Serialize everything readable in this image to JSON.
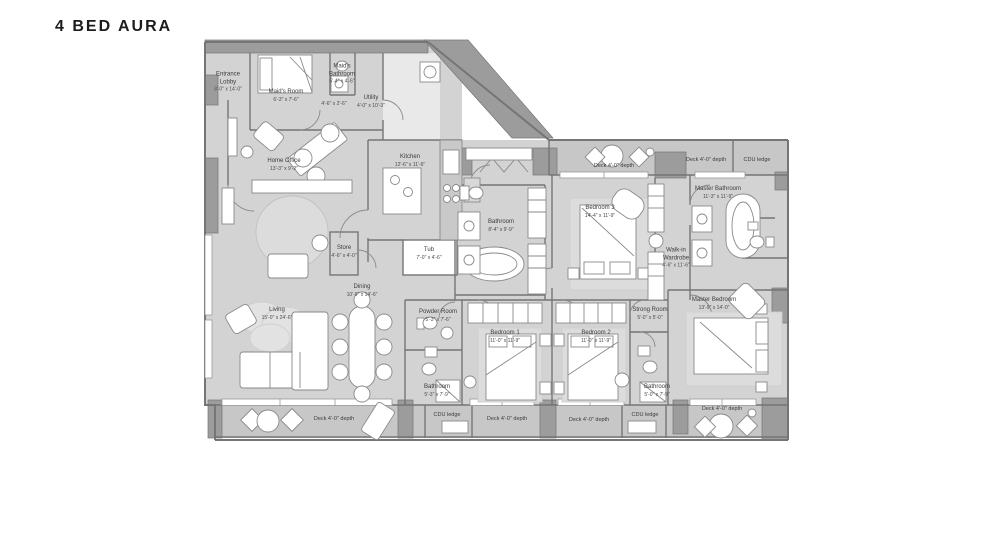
{
  "title": "4 BED AURA",
  "rooms": [
    {
      "name": "Entrance Lobby",
      "dims": "3'-0\" x 14'-0\""
    },
    {
      "name": "Maid's Room",
      "dims": "6'-3\" x 7'-6\""
    },
    {
      "name": "Maid's Bathroom",
      "dims": "5'-4\" x 4'-6\""
    },
    {
      "name": "Utility",
      "dims": "4'-0\" x 10'-3\""
    },
    {
      "name": "Home Office",
      "dims": "13'-3\" x 9'-2\""
    },
    {
      "name": "Kitchen",
      "dims": "12'-6\" x 11'-6\""
    },
    {
      "name": "Store",
      "dims": "4'-6\" x 4'-0\""
    },
    {
      "name": "Tub",
      "dims": "7'-0\" x 4'-6\""
    },
    {
      "name": "Bathroom",
      "dims": "8'-4\" x 9'-9\""
    },
    {
      "name": "Dining",
      "dims": "10'-9\" x 14'-6\""
    },
    {
      "name": "Living",
      "dims": "15'-0\" x 24'-6\""
    },
    {
      "name": "Bedroom 3",
      "dims": "14'-4\" x 11'-9\""
    },
    {
      "name": "Walk-in Wardrobe",
      "dims": "4'-6\" x 11'-6\""
    },
    {
      "name": "Master Bathroom",
      "dims": "11'-3\" x 11'-9\""
    },
    {
      "name": "Master Bedroom",
      "dims": "13'-9\" x 14'-0\""
    },
    {
      "name": "Strong Room",
      "dims": "5'-0\" x 5'-0\""
    },
    {
      "name": "Bedroom 1",
      "dims": "11'-0\" x 11'-9\""
    },
    {
      "name": "Bedroom 2",
      "dims": "11'-0\" x 11'-9\""
    },
    {
      "name": "Powder Room",
      "dims": "5'-3\" x 7'-6\""
    },
    {
      "name": "Bathroom",
      "dims": "5'-3\" x 7'-9\""
    },
    {
      "name": "Bathroom",
      "dims": "5'-0\" x 7'-9\""
    },
    {
      "name": "",
      "dims": "4'-6\" x 2'-6\""
    }
  ],
  "decks": [
    {
      "label": "Deck 4'-0\" depth"
    },
    {
      "label": "Deck 4'-0\" depth"
    },
    {
      "label": "CDU ledge"
    },
    {
      "label": "Deck 4'-0\" depth"
    },
    {
      "label": "CDU ledge"
    },
    {
      "label": "Deck 4'-0\" depth"
    },
    {
      "label": "Deck 4'-0\" depth"
    },
    {
      "label": "CDU ledge"
    },
    {
      "label": "Deck 4'-0\" depth"
    }
  ],
  "colors": {
    "floor": "#d3d3d3",
    "deck": "#c7c7c7",
    "wall_dark": "#9c9c9c",
    "wall_line": "#757575",
    "furniture_fill": "#ffffff",
    "rug": "#dcdcdc",
    "text": "#3c3c3c"
  }
}
